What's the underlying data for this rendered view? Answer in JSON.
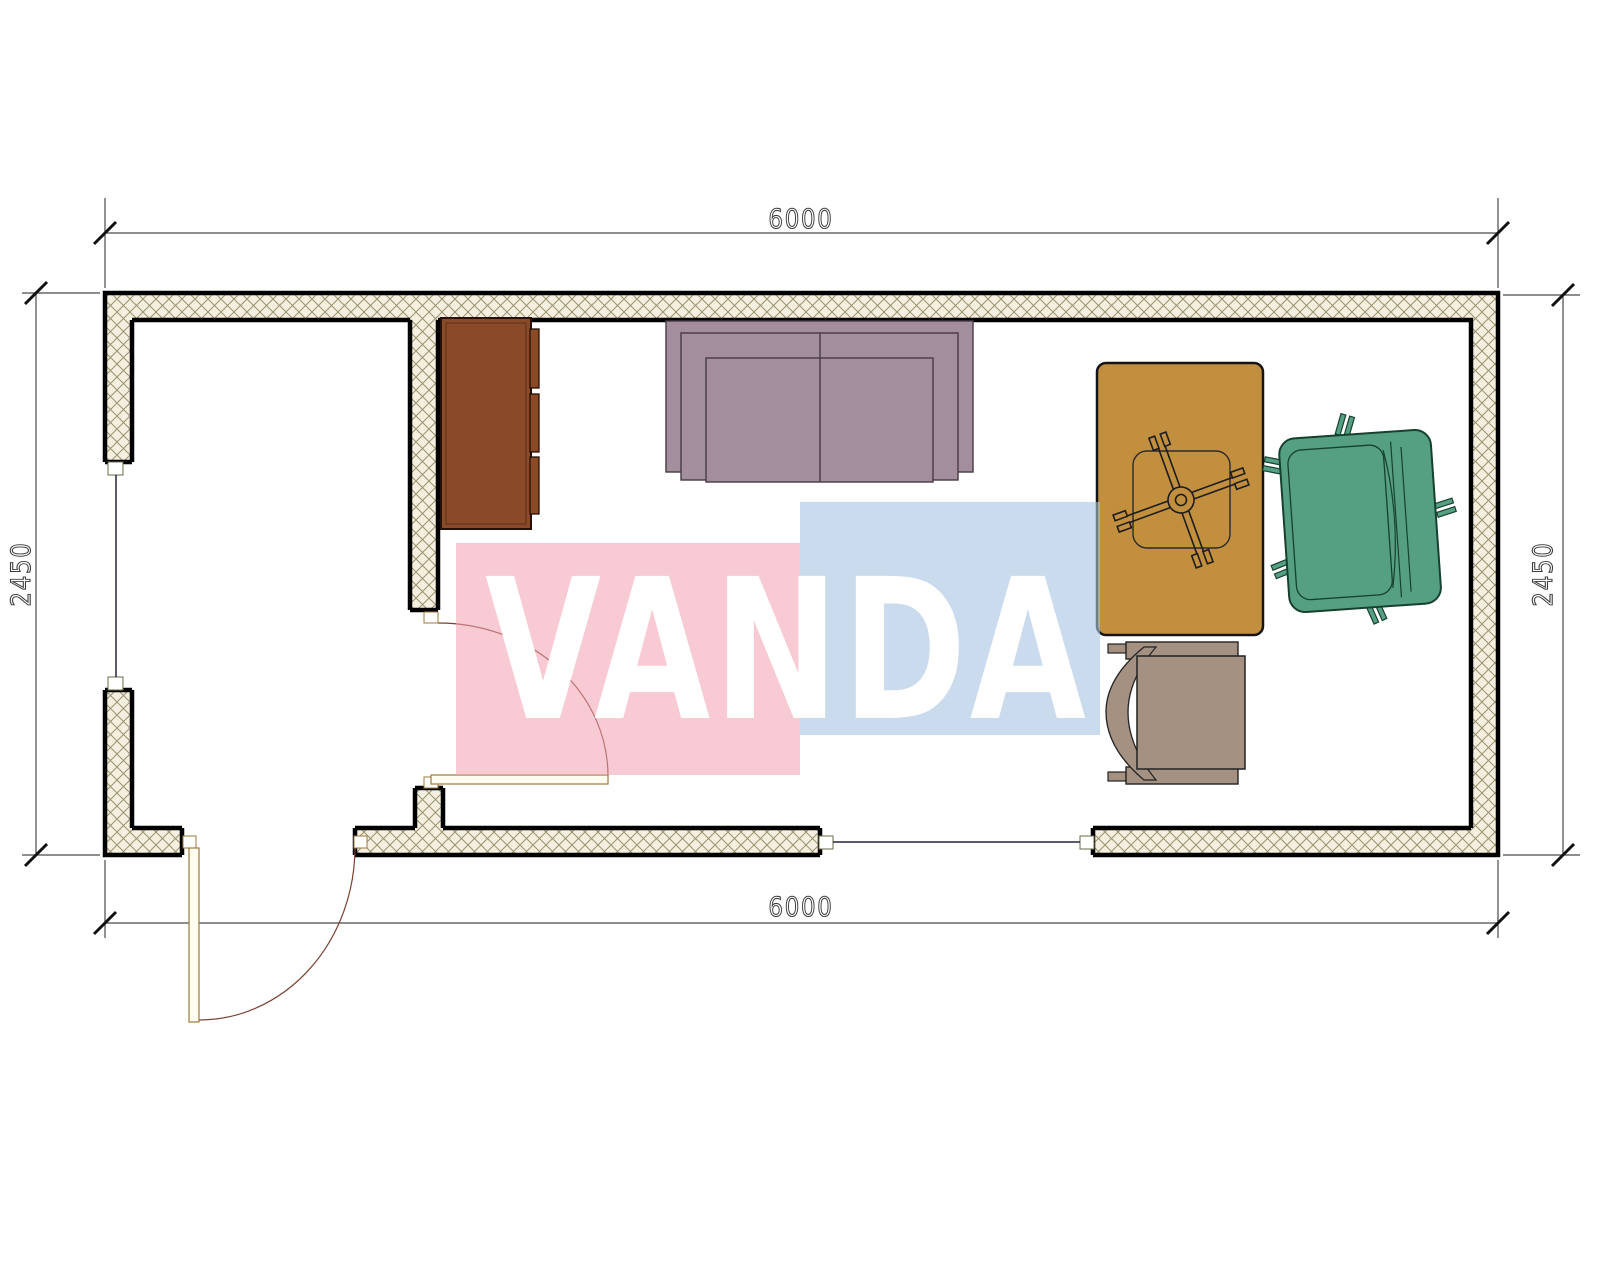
{
  "title": "floor-plan-6000x2450-container",
  "watermark": {
    "text": "VANDA",
    "pink_block": "rgba(242,158,175,0.55)",
    "blue_block": "rgba(165,195,225,0.60)",
    "text_color": "#ffffff"
  },
  "dimensions": {
    "top_width": "6000",
    "bottom_width": "6000",
    "left_height": "2450",
    "right_height": "2450"
  },
  "colors": {
    "wall_hatch_bg": "#f5efdf",
    "wall_hatch_line": "#9a916f",
    "wall_edge": "#000000",
    "dim_line": "#4a4a4a",
    "window_line": "#23233f",
    "door_line": "#9c7a3f",
    "door_arc": "#7a4030",
    "cabinet": "#8a4a28",
    "cabinet_edge": "#241004",
    "sofa": "#a28e9d",
    "sofa_edge": "#463a45",
    "desk": "#c28f3e",
    "desk_edge": "#141414",
    "armchair": "#55a083",
    "armchair_edge": "#17412f",
    "chair": "#a59181",
    "chair_edge": "#222222",
    "leaf_fill": "#fffdf0"
  },
  "objects": {
    "cabinet": "cabinet",
    "sofa": "sofa",
    "desk": "desk-with-chair-base",
    "armchair": "armchair",
    "chair": "side-chair",
    "window_left": "window",
    "window_bottom": "window",
    "door_interior": "interior-door",
    "door_exterior": "entrance-door"
  }
}
